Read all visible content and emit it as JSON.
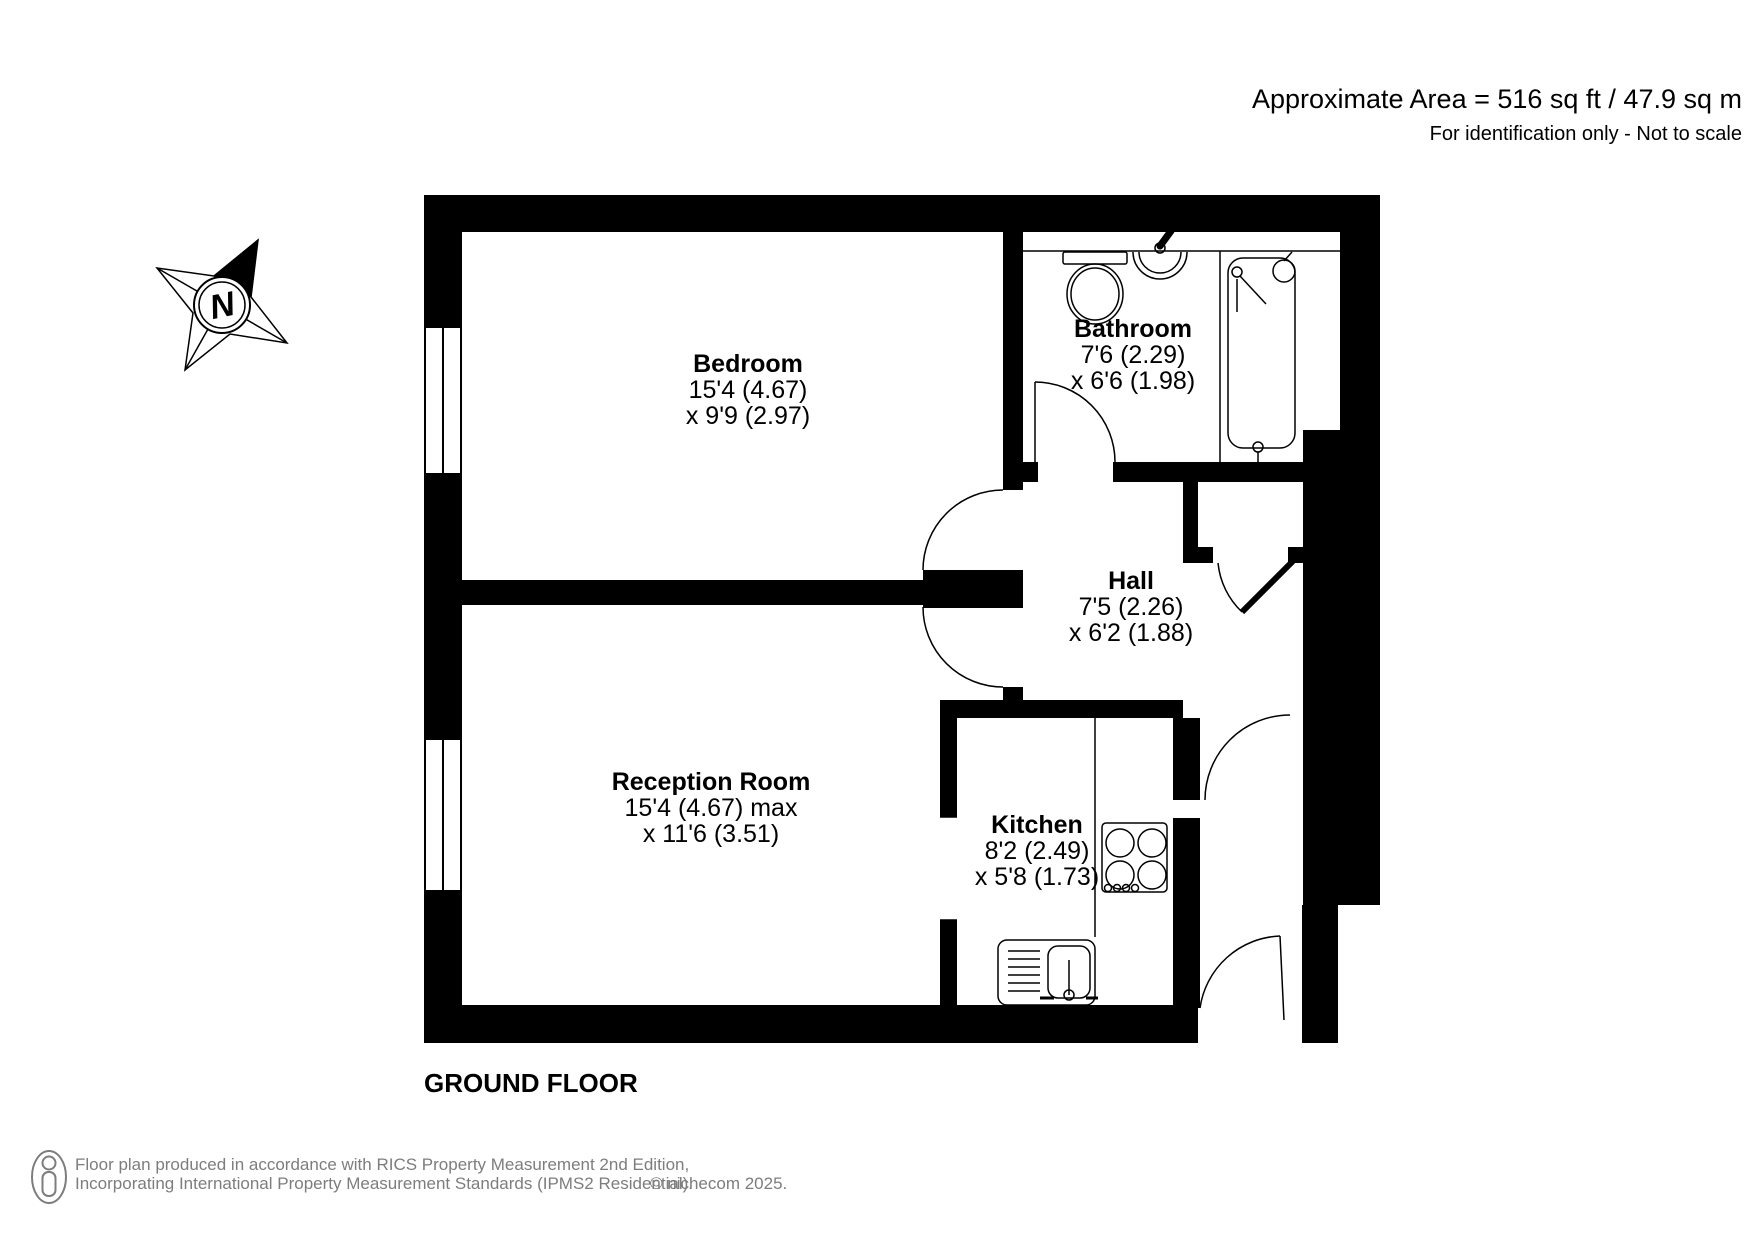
{
  "header": {
    "area_line": "Approximate Area = 516 sq ft / 47.9 sq m",
    "disclaimer": "For identification only - Not to scale"
  },
  "floor_label": "GROUND FLOOR",
  "compass": {
    "north_letter": "N"
  },
  "rooms": {
    "bedroom": {
      "name": "Bedroom",
      "dim1": "15'4 (4.67)",
      "dim2": "x 9'9 (2.97)"
    },
    "bathroom": {
      "name": "Bathroom",
      "dim1": "7'6 (2.29)",
      "dim2": "x 6'6 (1.98)"
    },
    "hall": {
      "name": "Hall",
      "dim1": "7'5 (2.26)",
      "dim2": "x 6'2 (1.88)"
    },
    "reception": {
      "name": "Reception Room",
      "dim1": "15'4 (4.67) max",
      "dim2": "x 11'6 (3.51)"
    },
    "kitchen": {
      "name": "Kitchen",
      "dim1": "8'2 (2.49)",
      "dim2": "x 5'8 (1.73)"
    }
  },
  "footer": {
    "line1": "Floor plan produced in accordance with RICS Property Measurement 2nd Edition,",
    "line2": "Incorporating International Property Measurement Standards (IPMS2 Residential).",
    "copyright": "© nichecom 2025."
  },
  "colors": {
    "walls": "#000000",
    "text": "#000000",
    "footer_text": "#7d7d7d",
    "background": "#ffffff"
  }
}
